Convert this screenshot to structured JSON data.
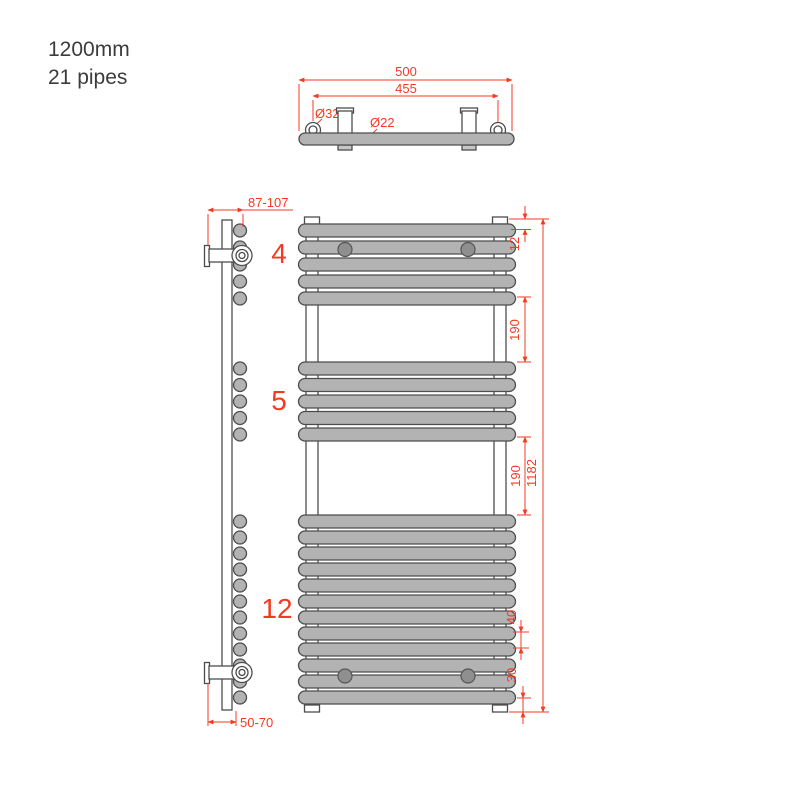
{
  "title": {
    "line1": "1200mm",
    "line2": "21 pipes"
  },
  "colors": {
    "red": "#f43a20",
    "pipe_fill": "#b3b3b3",
    "outline": "#4d4d4d"
  },
  "top_view": {
    "dim_overall_width": "500",
    "dim_collector_centers": "455",
    "dia_collector": "Ø32",
    "dia_pipe": "Ø22"
  },
  "side_view": {
    "dim_wall_distance_top": "87-107",
    "dim_wall_distance_bottom": "50-70"
  },
  "front_view": {
    "groups": [
      {
        "label": "4",
        "pipes_drawn": 5
      },
      {
        "label": "5",
        "pipes_drawn": 5
      },
      {
        "label": "12",
        "pipes_drawn": 12
      }
    ],
    "dims": {
      "top_gap": "12",
      "gap_upper": "190",
      "gap_lower": "190",
      "overall_height": "1182",
      "pipe_pitch": "40",
      "bottom_offset": "30"
    }
  }
}
